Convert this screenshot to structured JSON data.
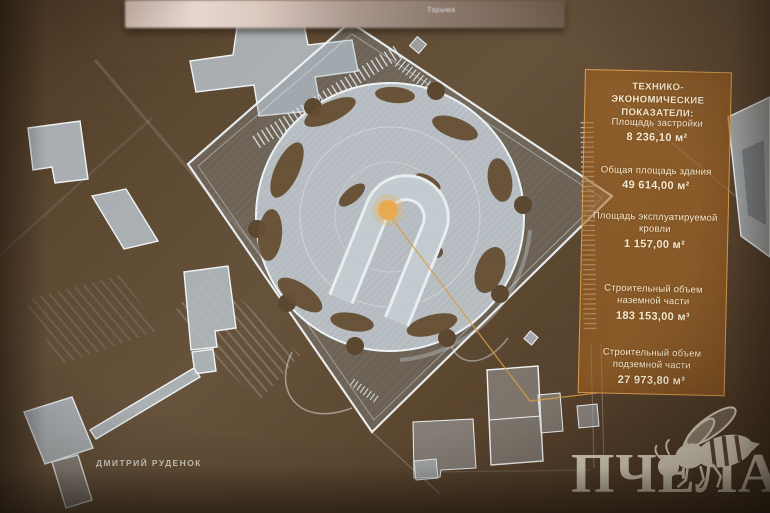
{
  "meta": {
    "top_label": "Тарыма",
    "photo_credit": "ДМИТРИЙ РУДЕНОК",
    "watermark": "ПЧЕЛА"
  },
  "panel": {
    "title": "ТЕХНИКО-ЭКОНОМИЧЕСКИЕ ПОКАЗАТЕЛИ:",
    "indicators": [
      {
        "label": "Площадь застройки",
        "value": "8 236,10 м²"
      },
      {
        "label": "Общая площадь здания",
        "value": "49 614,00 м²"
      },
      {
        "label": "Площадь эксплуатируемой кровли",
        "value": "1 157,00 м²"
      },
      {
        "label": "Строительный объем наземной части",
        "value": "183 153,00 м³"
      },
      {
        "label": "Строительный объем подземной части",
        "value": "27 973,80 м³"
      }
    ]
  },
  "icons": {
    "bee": "bee-icon"
  },
  "colors": {
    "photo_background": "#5a452f",
    "panel_fill": "rgba(173,106,36,0.58)",
    "panel_border": "rgba(233,168,88,0.85)",
    "panel_text": "#f3e8d0",
    "accent_orange": "#e8a94f",
    "leader_orange": "#d99b43",
    "building_fill": "#b7c1c9",
    "outline_white": "#eef3f5",
    "parcel_gray": "#8b96a0",
    "watermark_cream": "#d9d0bd"
  }
}
